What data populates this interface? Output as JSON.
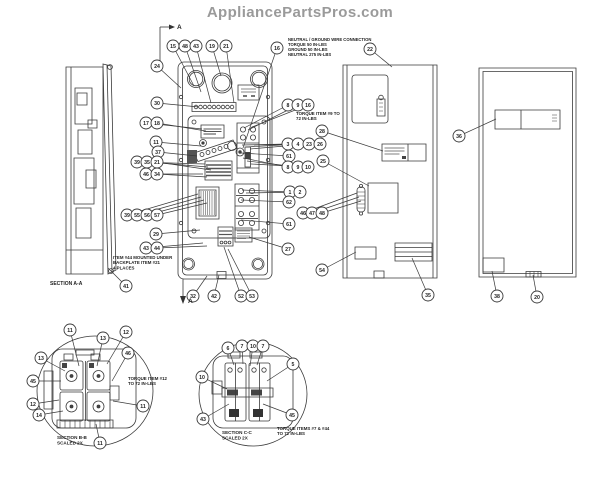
{
  "watermark": "AppliancePartsPros.com",
  "colors": {
    "line": "#3a3a3a",
    "dark_fill": "#444444",
    "watermark": "#9a9a9a",
    "background": "#ffffff"
  },
  "notes": [
    {
      "name": "neutral-ground-note",
      "x": 288,
      "y": 41,
      "fs": 4.2,
      "lines": [
        "NEUTRAL / GROUND WIRE CONNECTION",
        "TORQUE 50 IN-LBS",
        "GROUND 50 IN-LBS",
        "NEUTRAL 275 IN-LBS"
      ]
    },
    {
      "name": "torque-item9-note",
      "x": 296,
      "y": 115,
      "fs": 4.4,
      "lines": [
        "TORQUE ITEM #9 TO",
        "72 IN-LBS"
      ]
    },
    {
      "name": "item44-note",
      "x": 113,
      "y": 259,
      "fs": 4.4,
      "lines": [
        "ITEM #44 MOUNTED UNDER",
        "BACKPLATE ITEM #21",
        "4 PLACES"
      ]
    },
    {
      "name": "section-aa-label",
      "x": 50,
      "y": 285,
      "fs": 5,
      "lines": [
        "SECTION A-A"
      ]
    },
    {
      "name": "torque-item12-note",
      "x": 128,
      "y": 380,
      "fs": 4.4,
      "lines": [
        "TORQUE ITEM #12",
        "TO 72 IN-LBS"
      ]
    },
    {
      "name": "section-bb-label",
      "x": 57,
      "y": 439,
      "fs": 4.6,
      "lines": [
        "SECTION B-B",
        "SCALED 2X"
      ]
    },
    {
      "name": "torque-items7-44-note",
      "x": 277,
      "y": 430,
      "fs": 4.4,
      "lines": [
        "TORQUE ITEMS #7 & #44",
        "TO 72 IN-LBS"
      ]
    },
    {
      "name": "section-cc-label",
      "x": 222,
      "y": 434,
      "fs": 4.6,
      "lines": [
        "SECTION C-C",
        "SCALED 2X"
      ]
    },
    {
      "name": "section-a-top-label",
      "x": 177,
      "y": 29,
      "fs": 6.5,
      "lines": [
        "A"
      ]
    },
    {
      "name": "section-a-bottom-label",
      "x": 188,
      "y": 303,
      "fs": 6.5,
      "lines": [
        "A"
      ]
    }
  ],
  "callouts": [
    {
      "n": "15",
      "x": 173,
      "y": 46,
      "tx": 194,
      "ty": 86
    },
    {
      "n": "48",
      "x": 185,
      "y": 46,
      "tx": 201,
      "ty": 92
    },
    {
      "n": "43",
      "x": 196,
      "y": 46,
      "tx": 211,
      "ty": 103
    },
    {
      "n": "19",
      "x": 212,
      "y": 46,
      "tx": 221,
      "ty": 76
    },
    {
      "n": "21",
      "x": 226,
      "y": 46,
      "tx": 234,
      "ty": 103
    },
    {
      "n": "16",
      "x": 277,
      "y": 48,
      "tx": 243,
      "ty": 148
    },
    {
      "n": "22",
      "x": 370,
      "y": 49,
      "tx": 392,
      "ty": 67
    },
    {
      "n": "24",
      "x": 157,
      "y": 66,
      "tx": 181,
      "ty": 88
    },
    {
      "n": "30",
      "x": 157,
      "y": 103,
      "tx": 199,
      "ty": 107
    },
    {
      "n": "17",
      "x": 146,
      "y": 123,
      "tx": 202,
      "ty": 129
    },
    {
      "n": "18",
      "x": 157,
      "y": 123,
      "tx": 206,
      "ty": 131
    },
    {
      "n": "11",
      "x": 156,
      "y": 142,
      "tx": 201,
      "ty": 146
    },
    {
      "n": "37",
      "x": 158,
      "y": 152,
      "tx": 197,
      "ty": 156
    },
    {
      "n": "39",
      "x": 137,
      "y": 162,
      "tx": 205,
      "ty": 164
    },
    {
      "n": "35",
      "x": 147,
      "y": 162,
      "tx": 208,
      "ty": 167
    },
    {
      "n": "21",
      "x": 157,
      "y": 162,
      "tx": 211,
      "ty": 170
    },
    {
      "n": "46",
      "x": 146,
      "y": 174,
      "tx": 203,
      "ty": 174
    },
    {
      "n": "34",
      "x": 157,
      "y": 174,
      "tx": 207,
      "ty": 177
    },
    {
      "n": "39",
      "x": 127,
      "y": 215,
      "tx": 198,
      "ty": 194
    },
    {
      "n": "55",
      "x": 137,
      "y": 215,
      "tx": 201,
      "ty": 197
    },
    {
      "n": "56",
      "x": 147,
      "y": 215,
      "tx": 204,
      "ty": 200
    },
    {
      "n": "57",
      "x": 157,
      "y": 215,
      "tx": 207,
      "ty": 203
    },
    {
      "n": "29",
      "x": 156,
      "y": 234,
      "tx": 200,
      "ty": 230
    },
    {
      "n": "43",
      "x": 146,
      "y": 248,
      "tx": 203,
      "ty": 243
    },
    {
      "n": "44",
      "x": 157,
      "y": 248,
      "tx": 207,
      "ty": 246
    },
    {
      "n": "41",
      "x": 126,
      "y": 286,
      "tx": 108,
      "ty": 268
    },
    {
      "n": "32",
      "x": 193,
      "y": 296,
      "tx": 207,
      "ty": 276
    },
    {
      "n": "42",
      "x": 214,
      "y": 296,
      "tx": 219,
      "ty": 275
    },
    {
      "n": "52",
      "x": 241,
      "y": 296,
      "tx": 224,
      "ty": 247
    },
    {
      "n": "53",
      "x": 252,
      "y": 296,
      "tx": 228,
      "ty": 249
    },
    {
      "n": "8",
      "x": 288,
      "y": 105,
      "tx": 244,
      "ty": 128
    },
    {
      "n": "9",
      "x": 298,
      "y": 105,
      "tx": 248,
      "ty": 130
    },
    {
      "n": "16",
      "x": 308,
      "y": 105,
      "tx": 252,
      "ty": 127
    },
    {
      "n": "3",
      "x": 288,
      "y": 144,
      "tx": 242,
      "ty": 145
    },
    {
      "n": "4",
      "x": 298,
      "y": 144,
      "tx": 246,
      "ty": 147
    },
    {
      "n": "23",
      "x": 309,
      "y": 144,
      "tx": 250,
      "ty": 149
    },
    {
      "n": "26",
      "x": 320,
      "y": 144,
      "tx": 254,
      "ty": 145
    },
    {
      "n": "61",
      "x": 289,
      "y": 156,
      "tx": 241,
      "ty": 153
    },
    {
      "n": "8",
      "x": 288,
      "y": 167,
      "tx": 243,
      "ty": 158
    },
    {
      "n": "9",
      "x": 298,
      "y": 167,
      "tx": 247,
      "ty": 161
    },
    {
      "n": "10",
      "x": 308,
      "y": 167,
      "tx": 251,
      "ty": 164
    },
    {
      "n": "1",
      "x": 290,
      "y": 192,
      "tx": 242,
      "ty": 190
    },
    {
      "n": "2",
      "x": 300,
      "y": 192,
      "tx": 246,
      "ty": 193
    },
    {
      "n": "62",
      "x": 289,
      "y": 202,
      "tx": 241,
      "ty": 200
    },
    {
      "n": "46",
      "x": 303,
      "y": 213,
      "tx": 357,
      "ty": 193
    },
    {
      "n": "47",
      "x": 312,
      "y": 213,
      "tx": 359,
      "ty": 197
    },
    {
      "n": "48",
      "x": 322,
      "y": 213,
      "tx": 361,
      "ty": 201
    },
    {
      "n": "61",
      "x": 289,
      "y": 224,
      "tx": 241,
      "ty": 220
    },
    {
      "n": "27",
      "x": 288,
      "y": 249,
      "tx": 249,
      "ty": 237
    },
    {
      "n": "28",
      "x": 322,
      "y": 131,
      "tx": 383,
      "ty": 151
    },
    {
      "n": "25",
      "x": 323,
      "y": 161,
      "tx": 369,
      "ty": 186
    },
    {
      "n": "54",
      "x": 322,
      "y": 270,
      "tx": 356,
      "ty": 252
    },
    {
      "n": "35",
      "x": 428,
      "y": 295,
      "tx": 412,
      "ty": 258
    },
    {
      "n": "36",
      "x": 459,
      "y": 136,
      "tx": 496,
      "ty": 119
    },
    {
      "n": "38",
      "x": 497,
      "y": 296,
      "tx": 492,
      "ty": 271
    },
    {
      "n": "20",
      "x": 537,
      "y": 297,
      "tx": 533,
      "ty": 275
    },
    {
      "n": "11",
      "x": 70,
      "y": 330,
      "tx": 79,
      "ty": 366
    },
    {
      "n": "13",
      "x": 103,
      "y": 338,
      "tx": 97,
      "ty": 366
    },
    {
      "n": "12",
      "x": 126,
      "y": 332,
      "tx": 107,
      "ty": 364
    },
    {
      "n": "46",
      "x": 128,
      "y": 353,
      "tx": 112,
      "ty": 381
    },
    {
      "n": "13",
      "x": 41,
      "y": 358,
      "tx": 65,
      "ty": 371
    },
    {
      "n": "45",
      "x": 33,
      "y": 381,
      "tx": 61,
      "ty": 381
    },
    {
      "n": "12",
      "x": 33,
      "y": 404,
      "tx": 59,
      "ty": 400
    },
    {
      "n": "14",
      "x": 39,
      "y": 415,
      "tx": 63,
      "ty": 411
    },
    {
      "n": "11",
      "x": 143,
      "y": 406,
      "tx": 113,
      "ty": 401
    },
    {
      "n": "11",
      "x": 100,
      "y": 443,
      "tx": 96,
      "ty": 424
    },
    {
      "n": "6",
      "x": 228,
      "y": 348,
      "tx": 234,
      "ty": 365
    },
    {
      "n": "7",
      "x": 242,
      "y": 346,
      "tx": 243,
      "ty": 364
    },
    {
      "n": "10",
      "x": 253,
      "y": 346,
      "tx": 250,
      "ty": 366
    },
    {
      "n": "7",
      "x": 263,
      "y": 346,
      "tx": 257,
      "ty": 365
    },
    {
      "n": "5",
      "x": 293,
      "y": 364,
      "tx": 267,
      "ty": 381
    },
    {
      "n": "10",
      "x": 202,
      "y": 377,
      "tx": 227,
      "ty": 389
    },
    {
      "n": "43",
      "x": 203,
      "y": 419,
      "tx": 229,
      "ty": 404
    },
    {
      "n": "45",
      "x": 292,
      "y": 415,
      "tx": 263,
      "ty": 404
    }
  ]
}
